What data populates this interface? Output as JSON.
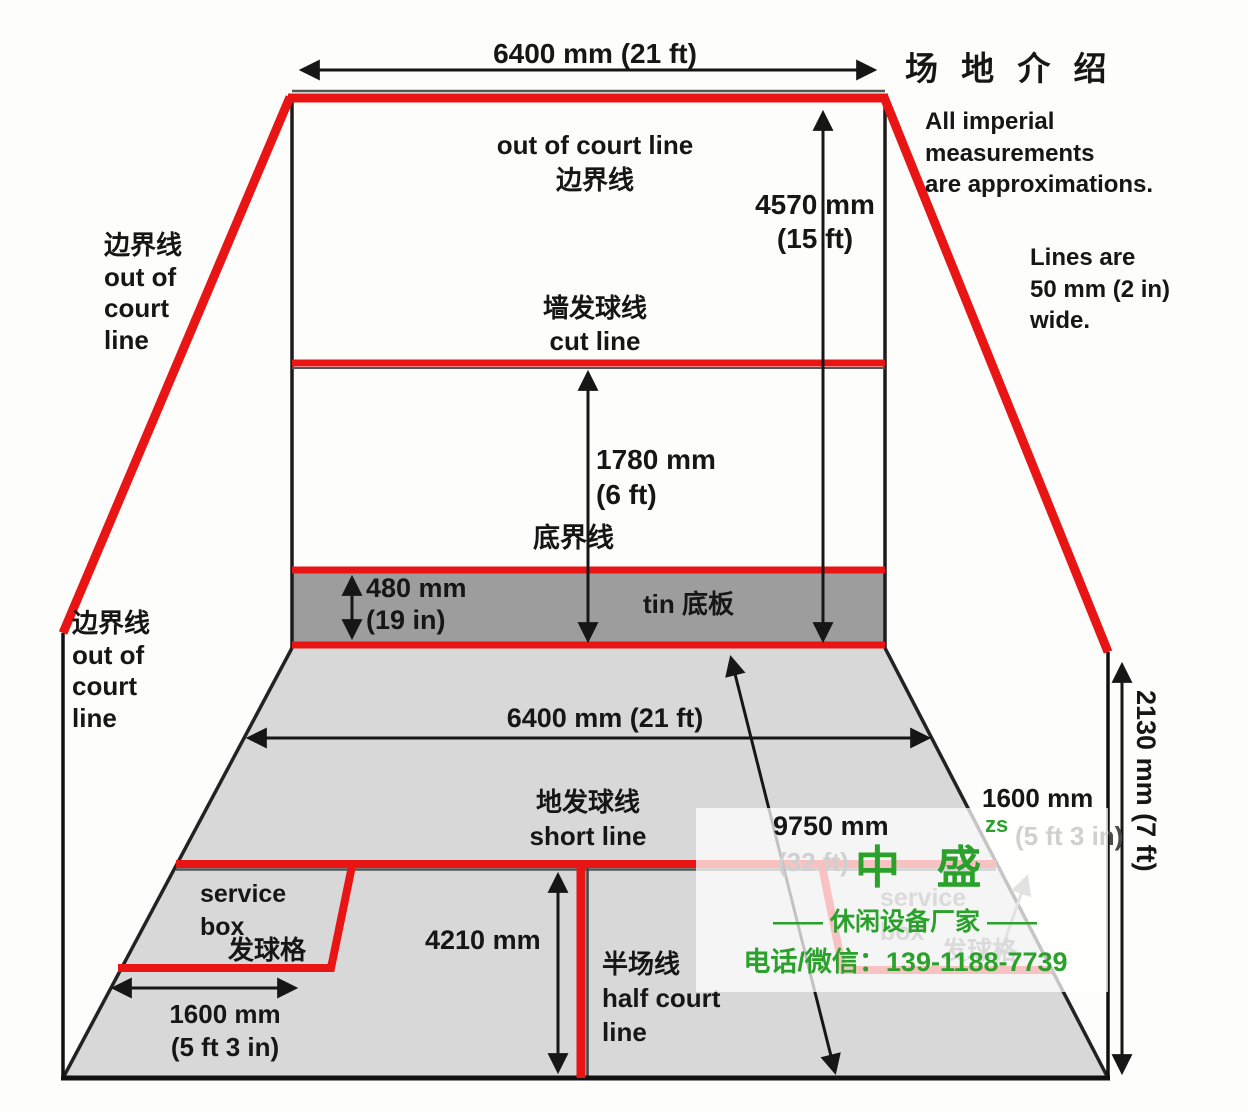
{
  "colors": {
    "court_line_red": "#e91414",
    "watermark_green": "#2aa12a",
    "tin_gray": "#9d9d9d",
    "floor_gray": "#d8d8d8"
  },
  "header": {
    "title": "场 地 介 绍",
    "imperial_note": "All imperial\nmeasurements\nare approximations.",
    "line_width_note": "Lines are\n50 mm (2 in)\nwide."
  },
  "wall_labels": {
    "out_of_court_top": "out of court line\n边界线",
    "out_of_court_left_upper": "边界线\nout of\ncourt\nline",
    "out_of_court_left_lower": "边界线\nout of\ncourt\nline",
    "cut_line": "墙发球线\ncut line",
    "board_line": "底界线",
    "tin": "tin 底板"
  },
  "floor_labels": {
    "short_line": "地发球线\nshort line",
    "half_court_line": "半场线\nhalf court\nline",
    "service_box_en": "service\nbox",
    "service_box_zh": "发球格",
    "service_box_right_en": "service\nbox",
    "service_box_right_zh": "发球格"
  },
  "dimensions": {
    "front_wall_width": "6400 mm (21 ft)",
    "front_wall_height": "4570 mm\n(15 ft)",
    "cut_line_height": "1780 mm\n(6 ft)",
    "tin_height": "480 mm\n(19 in)",
    "floor_width": "6400 mm (21 ft)",
    "court_length": "9750 mm",
    "court_length_ft": "(32 ft)",
    "short_line_to_back": "4210 mm",
    "service_box_width_left": "1600 mm\n(5 ft 3 in)",
    "service_box_width_right": "1600 mm",
    "service_box_width_right_ft": "(5 ft 3 in)",
    "back_wall_height": "2130 mm (7 ft)"
  },
  "watermark": {
    "brand": "中 盛",
    "initials": "zs",
    "tagline": "——  休闲设备厂家  ——",
    "phone": "电话/微信：139-1188-7739"
  }
}
